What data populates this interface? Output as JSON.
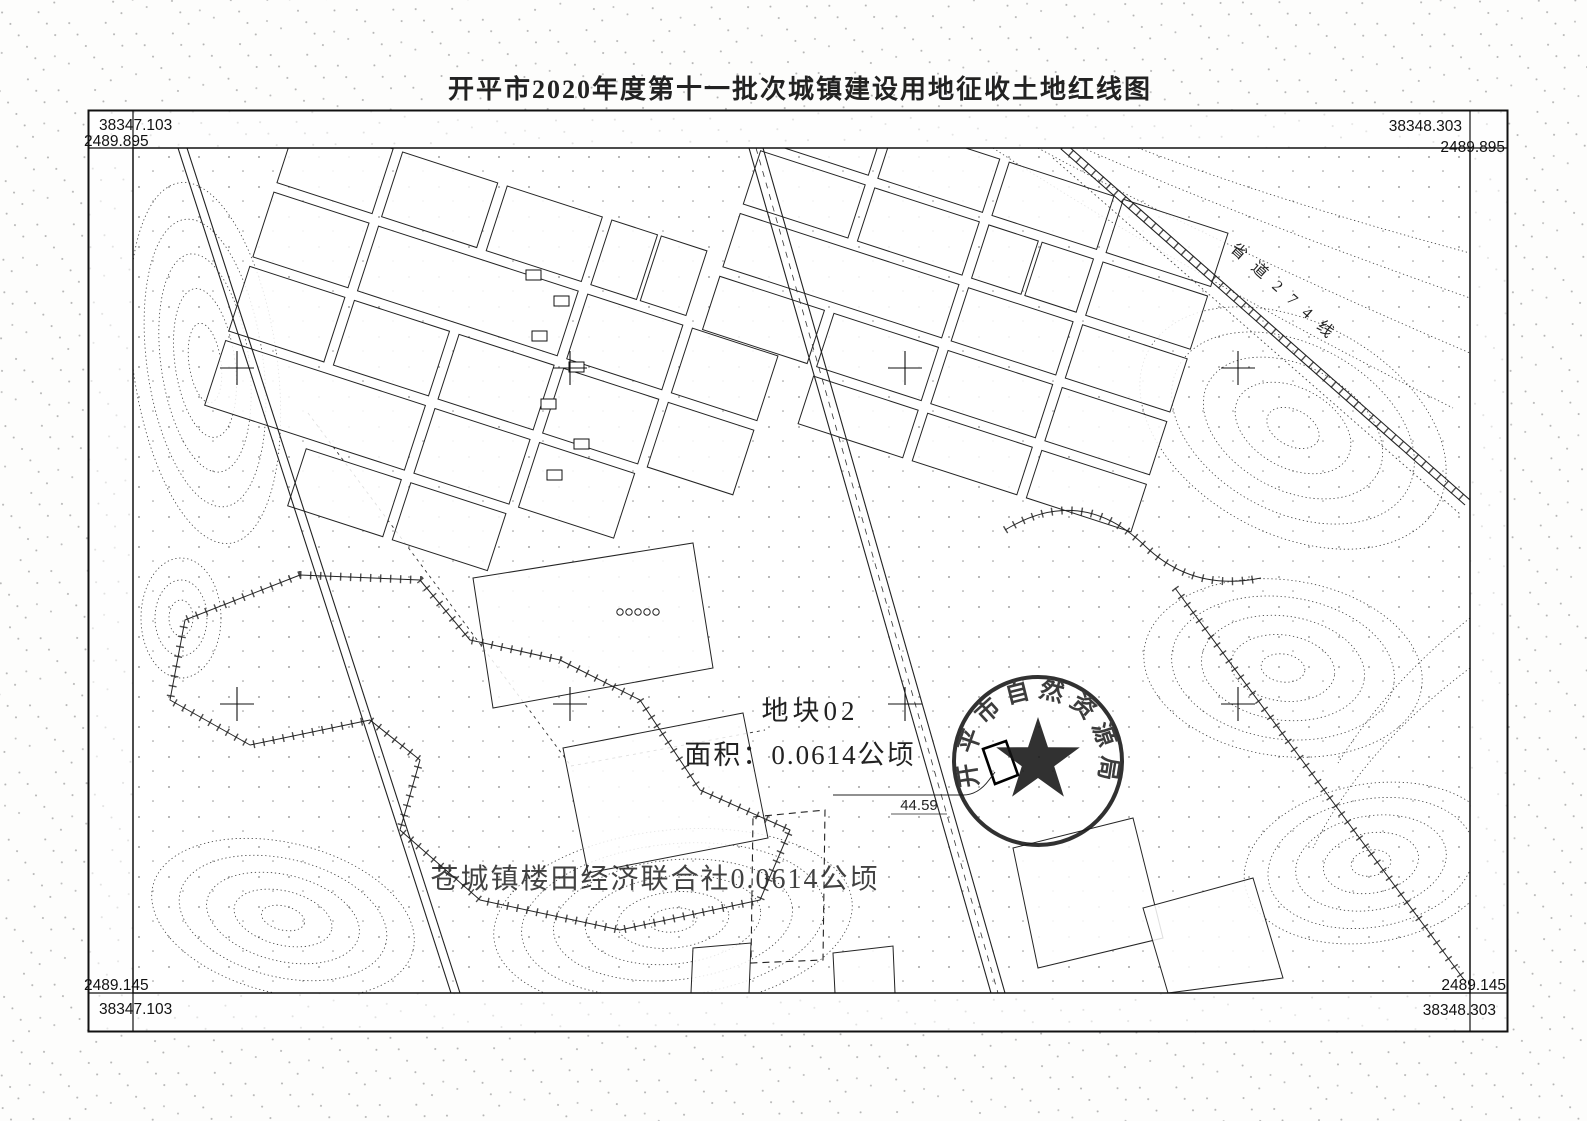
{
  "title": "开平市2020年度第十一批次城镇建设用地征收土地红线图",
  "corners": {
    "top_left": {
      "x": "38347.103",
      "y": "2489.895"
    },
    "top_right": {
      "x": "38348.303",
      "y": "2489.895"
    },
    "bottom_left": {
      "x": "38347.103",
      "y": "2489.145"
    },
    "bottom_right": {
      "x": "38348.303",
      "y": "2489.145"
    }
  },
  "map": {
    "plot_label": "地块02",
    "area_label": "面积：0.0614公顷",
    "owner_label": "苍城镇楼田经济联合社0.0614公顷",
    "dimension_label": "44.59",
    "road_label": "省道274线",
    "seal_text": "开平市自然资源局"
  },
  "colors": {
    "ink": "#1a1a1a",
    "contour": "#3c3c3c",
    "texture": "#9a9a9a"
  }
}
